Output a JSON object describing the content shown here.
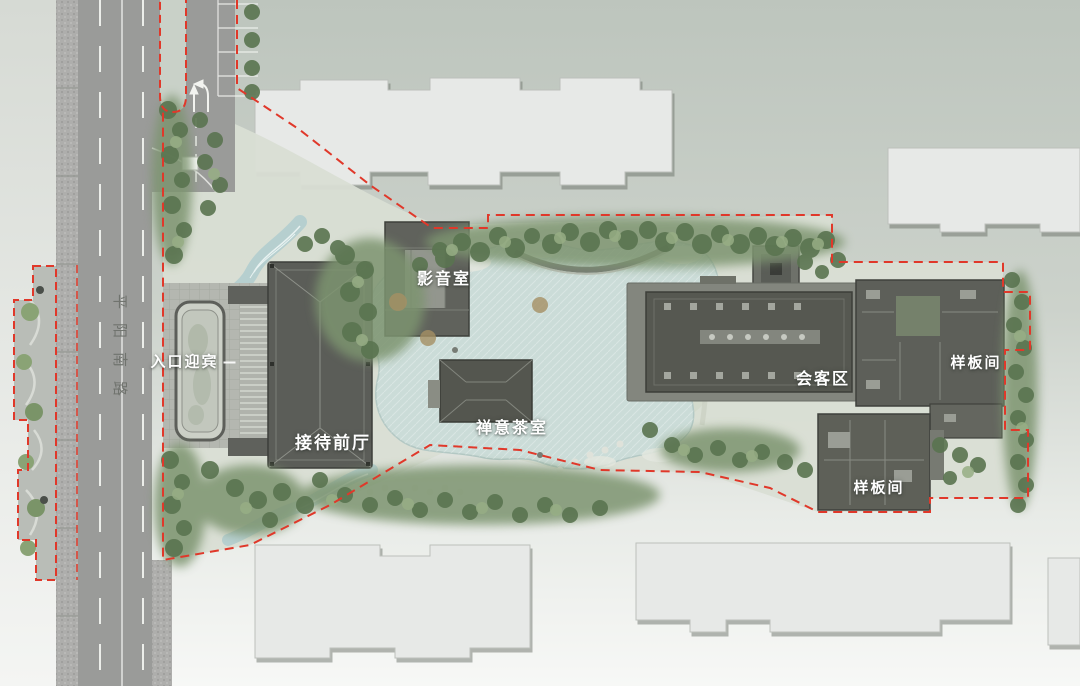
{
  "road": {
    "name": "平阳南路"
  },
  "areas": [
    {
      "id": "entrance",
      "label": "入口迎宾"
    },
    {
      "id": "reception-hall",
      "label": "接待前厅"
    },
    {
      "id": "av-room",
      "label": "影音室"
    },
    {
      "id": "tea-room",
      "label": "禅意茶室"
    },
    {
      "id": "lounge",
      "label": "会客区"
    },
    {
      "id": "model-room-east",
      "label": "样板间"
    },
    {
      "id": "model-room-south",
      "label": "样板间"
    }
  ],
  "colors": {
    "background_top": "#bec6be",
    "background_bottom": "#f7f8f6",
    "road": "#9a9b99",
    "sidewalk": "#aeaeac",
    "boundary_red": "#e0382a",
    "water": "#cbdcd8",
    "tree_dark": "#5a7450",
    "tree_light": "#97ae85",
    "building_light": "#e7e9e7",
    "building_dark": "#5a5c58",
    "plaza": "#b4b7b0",
    "label_text": "#ffffff"
  }
}
